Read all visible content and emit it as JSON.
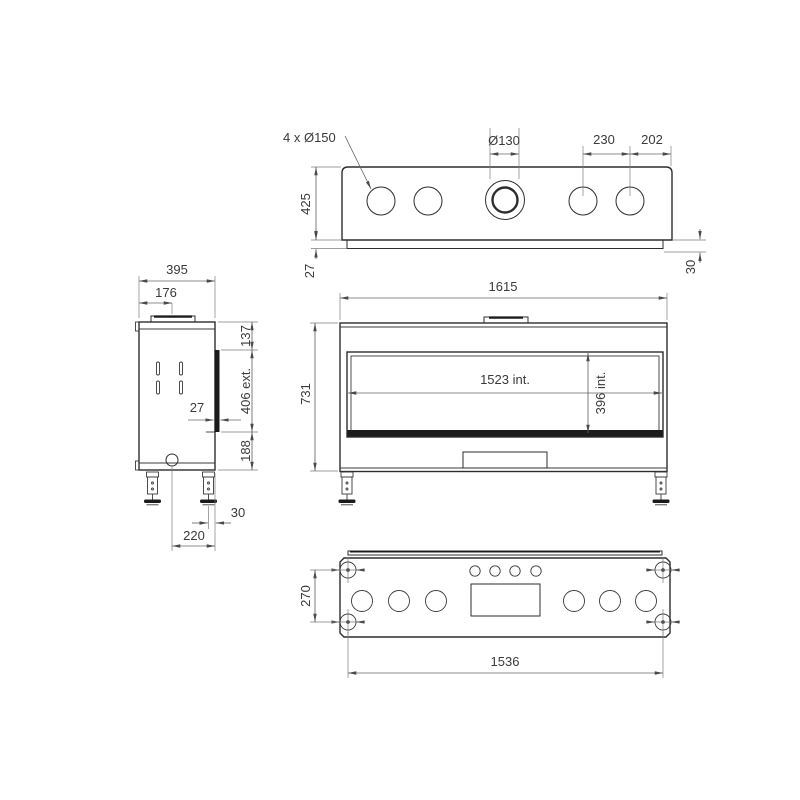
{
  "colors": {
    "background": "#ffffff",
    "object_line": "#2d2d2d",
    "dimension_line": "#666666",
    "dark_fill": "#1b1b1b",
    "text": "#3a3a3a"
  },
  "views": {
    "top": {
      "dims": {
        "hole_callout": "4 x Ø150",
        "flue_diameter": "Ø130",
        "hole_spacing": "230",
        "edge_offset": "202",
        "depth": "425",
        "lip_left": "27",
        "lip_right": "30"
      }
    },
    "side": {
      "dims": {
        "depth": "395",
        "flue_axis_offset": "176",
        "top_section": "137",
        "glass_section": "406 ext.",
        "bottom_section": "188",
        "glass_projection": "27",
        "leg_to_back": "30",
        "axis_to_back": "220"
      }
    },
    "front": {
      "dims": {
        "overall_width": "1615",
        "overall_height": "731",
        "interior_width": "1523 int.",
        "interior_height": "396 int."
      }
    },
    "bottom": {
      "dims": {
        "leg_pitch_depth": "270",
        "leg_pitch_width": "1536"
      }
    }
  }
}
